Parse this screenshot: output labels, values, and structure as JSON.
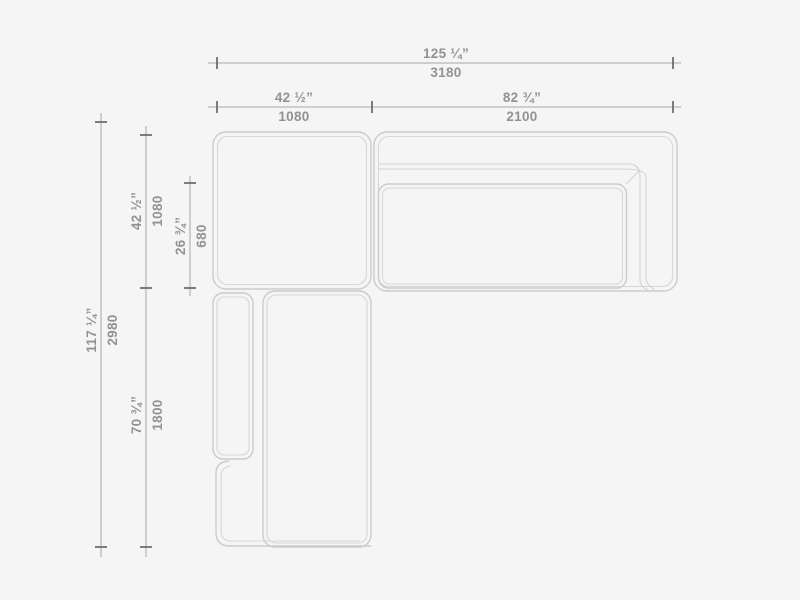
{
  "drawing": {
    "title": "Sectional sofa top-view dimension drawing",
    "units": [
      "inches",
      "mm"
    ]
  },
  "colors": {
    "background": "#f5f5f5",
    "sofa_outline": "#cbcbcb",
    "dimension_line": "#a6a6a6",
    "tick": "#6f6f6f",
    "label_text": "#929292"
  },
  "dimensions": {
    "width_total": {
      "in": "125 ¼”",
      "mm": "3180"
    },
    "width_left": {
      "in": "42 ½”",
      "mm": "1080"
    },
    "width_right": {
      "in": "82 ¾”",
      "mm": "2100"
    },
    "depth_total": {
      "in": "117 ¼”",
      "mm": "2980"
    },
    "depth_top": {
      "in": "42 ½”",
      "mm": "1080"
    },
    "seat_depth": {
      "in": "26 ¾”",
      "mm": "680"
    },
    "chaise_length": {
      "in": "70 ¾”",
      "mm": "1800"
    }
  }
}
